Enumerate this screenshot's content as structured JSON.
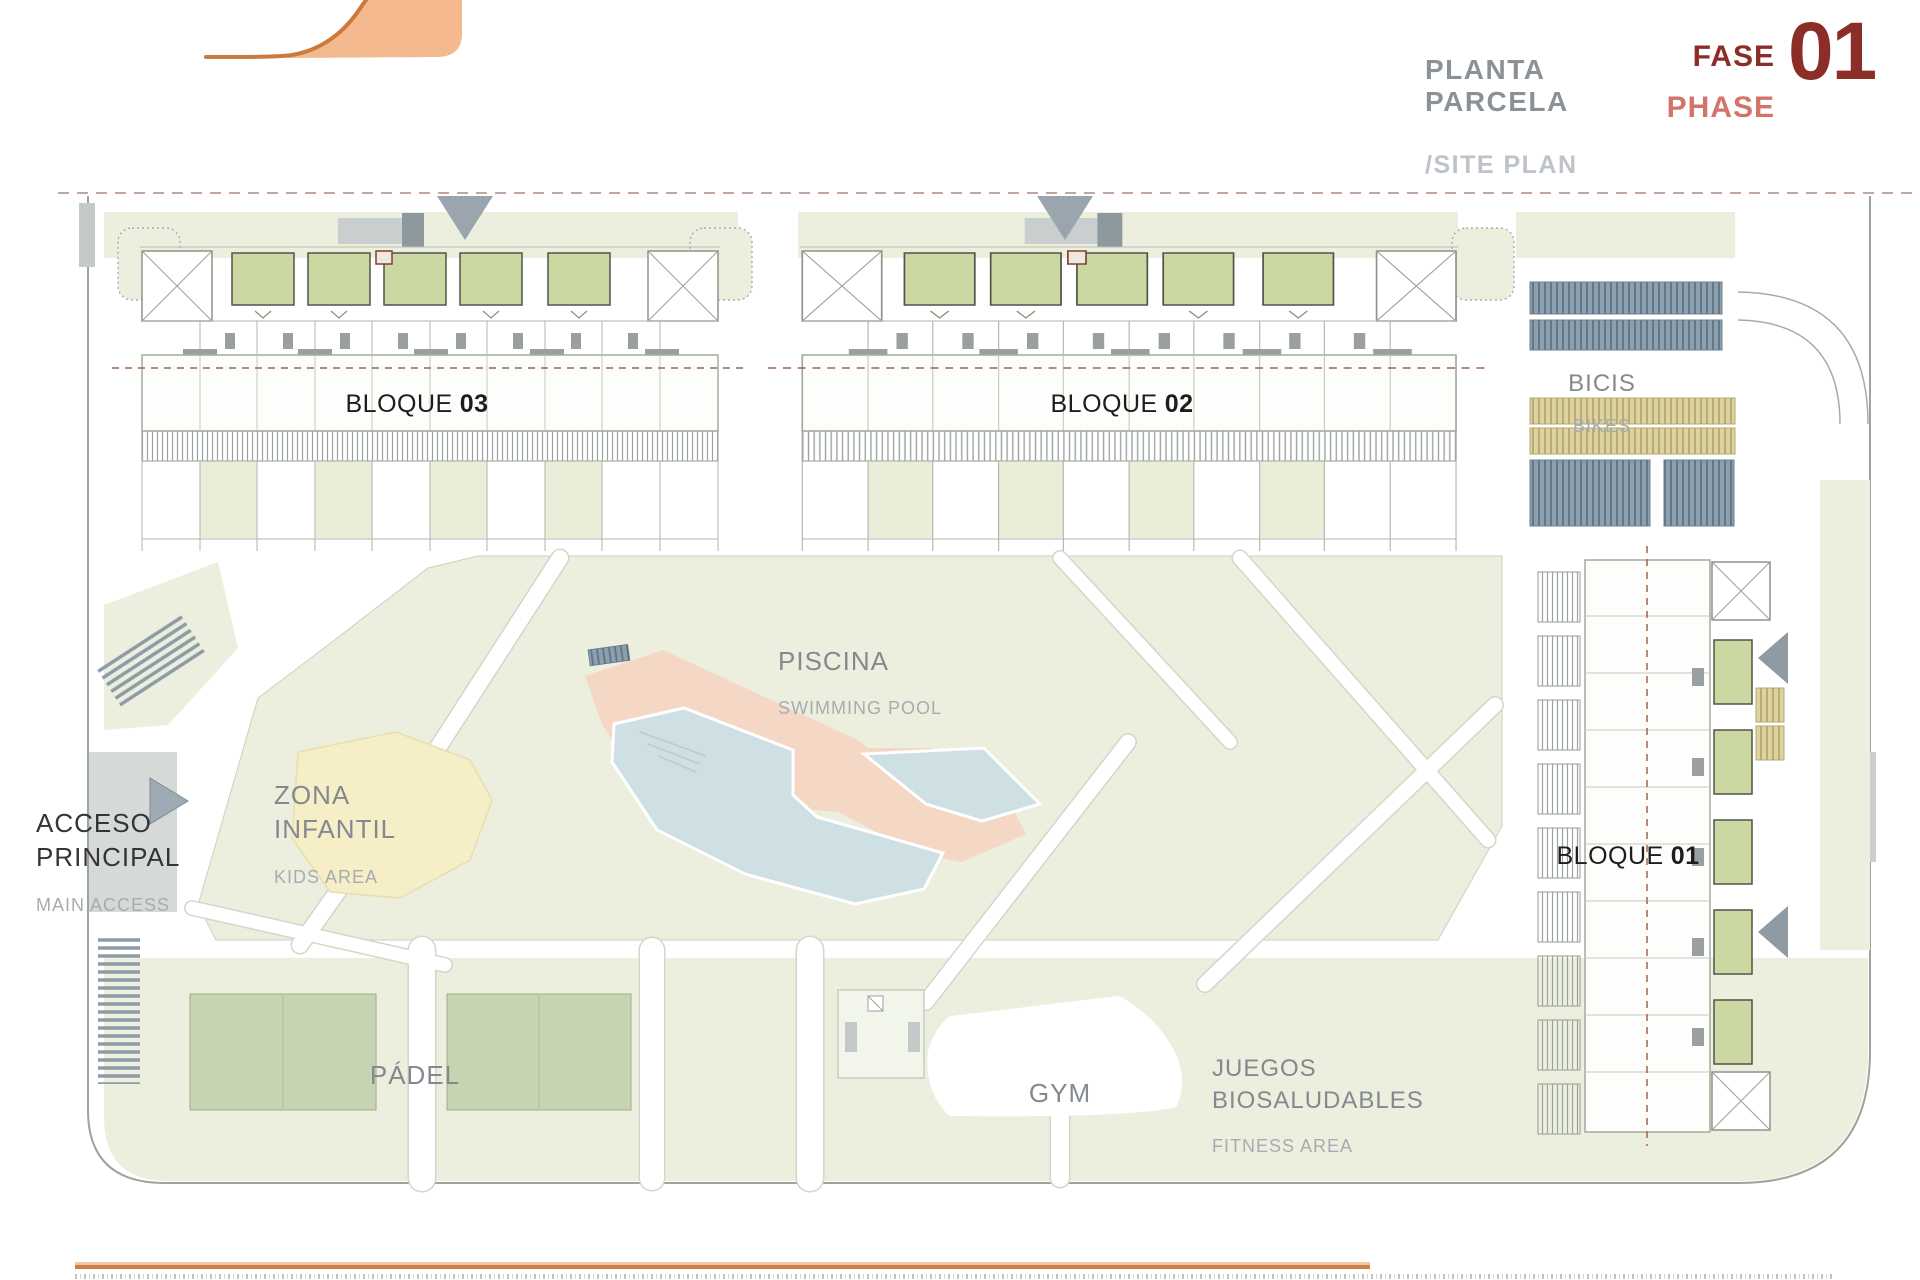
{
  "header": {
    "title": "PLANTA PARCELA",
    "subtitle": "/SITE PLAN",
    "phase": {
      "label_es": "FASE",
      "label_en": "PHASE",
      "number": "01"
    }
  },
  "plan": {
    "blocks": [
      {
        "id": "bloque-03",
        "label": "BLOQUE",
        "number": "03"
      },
      {
        "id": "bloque-02",
        "label": "BLOQUE",
        "number": "02"
      },
      {
        "id": "bloque-01",
        "label": "BLOQUE",
        "number": "01"
      }
    ],
    "areas": {
      "bikes": {
        "es": "BICIS",
        "en": "BIKES"
      },
      "pool": {
        "es": "PISCINA",
        "en": "SWIMMING POOL"
      },
      "kids": {
        "es": "ZONA INFANTIL",
        "en": "KIDS AREA"
      },
      "access": {
        "es": "ACCESO PRINCIPAL",
        "en": "MAIN ACCESS"
      },
      "padel": {
        "es": "PÁDEL"
      },
      "gym": {
        "es": "GYM"
      },
      "fitness": {
        "es": "JUEGOS BIOSALUDABLES",
        "en": "FITNESS AREA"
      }
    }
  },
  "colors": {
    "brand_orange_fill": "#f4b98e",
    "brand_orange_stroke": "#cc7a3c",
    "phase_dark_red": "#8c2e27",
    "phase_light_red": "#d4736b",
    "title_gray": "#8a9298",
    "landscape_green": "#ecefdd",
    "court_green": "#c6d4b2",
    "terrace_green": "#cbd8a2",
    "pool_blue": "#cfe0e4",
    "deck_peach": "#f5d7c5",
    "kids_yellow": "#f6eec6",
    "bike_rack_blue": "#8da0ad",
    "bike_rack_tan": "#ddd2a2"
  }
}
